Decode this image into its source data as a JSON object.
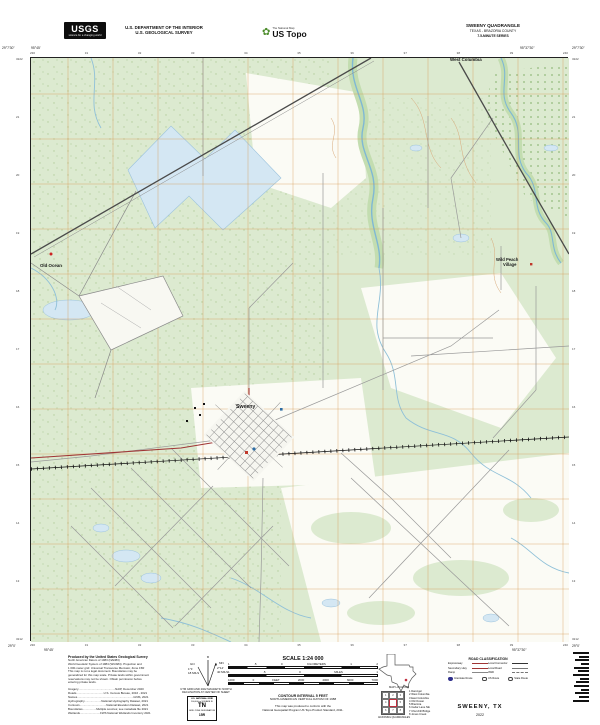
{
  "header": {
    "usgs_logo_text": "USGS",
    "usgs_tagline": "science for a changing world",
    "dept_line1": "U.S. DEPARTMENT OF THE INTERIOR",
    "dept_line2": "U.S. GEOLOGICAL SURVEY",
    "ustopo_small": "The National Map",
    "ustopo_large": "US Topo",
    "quad_line1": "SWEENY QUADRANGLE",
    "quad_line2": "TEXAS - BRAZORIA COUNTY",
    "quad_line3": "7.5-MINUTE SERIES"
  },
  "map": {
    "corner_tl_lat": "29°7'30\"",
    "corner_tl_lon": "95°45'",
    "corner_tr_lat": "29°7'30\"",
    "corner_tr_lon": "95°37'30\"",
    "corner_bl_lat": "29°0'",
    "corner_bl_lon": "95°45'",
    "corner_br_lat": "29°0'",
    "corner_br_lon": "95°37'30\"",
    "top_ticks": [
      "230",
      "31",
      "32",
      "33",
      "34",
      "35",
      "36",
      "37",
      "38",
      "39",
      "240"
    ],
    "bottom_ticks": [
      "230",
      "31",
      "32",
      "33",
      "34",
      "35",
      "36",
      "37",
      "38",
      "39",
      "240"
    ],
    "left_ticks": [
      "3222",
      "21",
      "20",
      "19",
      "18",
      "17",
      "16",
      "15",
      "14",
      "13",
      "3212"
    ],
    "right_ticks": [
      "3222",
      "21",
      "20",
      "19",
      "18",
      "17",
      "16",
      "15",
      "14",
      "13",
      "3212"
    ],
    "labels": {
      "town": "Sweeny",
      "old_ocean": "Old Ocean",
      "west_columbia": "West Columbia",
      "wild_peach_1": "Wild Peach",
      "wild_peach_2": "Village"
    }
  },
  "footer": {
    "credits_title": "Produced by the United States Geological Survey",
    "credits_lines": [
      "North American Datum of 1983 (NAD83)",
      "World Geodetic System of 1984 (WGS84). Projection and",
      "1 000-meter grid: Universal Transverse Mercator, Zone 15R",
      "This map is not a legal document. Boundaries may be",
      "generalized for this map scale. Private lands within government",
      "reservations may not be shown. Obtain permission before",
      "entering private lands."
    ],
    "source_lines": [
      "Imagery..............................................NAIP, December 2020",
      "Roads..................................U.S. Census Bureau, 2016 - 2021",
      "Names......................................................................GNIS, 2021",
      "Hydrography.....................National Hydrography Dataset, 2021",
      "Contours.................................National Elevation Dataset, 2021",
      "Boundaries.................Multiple sources; see metadata file 2021",
      "Wetlands.........................FWS National Wetlands Inventory 2021"
    ],
    "declination": {
      "star": "★",
      "mn_label": "MN",
      "mn_deg": "2°14'",
      "mn_mils": "40 MILS",
      "gn_label": "GN",
      "gn_deg": "1°1'",
      "gn_mils": "18 MILS",
      "caption1": "UTM GRID AND 2022 MAGNETIC NORTH",
      "caption2": "DECLINATION AT CENTER OF SHEET"
    },
    "usng": {
      "title": "U.S. NATIONAL GRID",
      "subtitle": "100,000-m SQUARE ID",
      "square_id": "TN",
      "zone_label": "GRID ZONE DESIGNATION",
      "zone": "15R"
    },
    "scale": {
      "title": "SCALE 1:24 000",
      "km_ticks": [
        "1",
        ".5",
        "0",
        "KILOMETERS",
        "1",
        "2"
      ],
      "mi_ticks": [
        "1",
        ".5",
        "0",
        "MILES",
        "1"
      ],
      "ft_ticks": [
        "1000",
        "0",
        "FEET",
        "2000",
        "4000",
        "6000",
        "7000"
      ]
    },
    "contour_line": "CONTOUR INTERVAL 5 FEET",
    "datum_line": "NORTH AMERICAN VERTICAL DATUM OF 1988",
    "conform_line1": "This map was produced to conform with the",
    "conform_line2": "National Geospatial Program US Topo Product Standard, 2011.",
    "map_location_caption": "MAP LOCATION",
    "adjoining": {
      "caption": "ADJOINING QUADRANGLES",
      "cells": [
        "1",
        "2",
        "3",
        "4",
        "",
        "5",
        "6",
        "7",
        "8"
      ],
      "names": [
        "1 Danciger",
        "2 West Columbia",
        "3 East Columbia",
        "4 Old Ocean",
        "5 Brazoria",
        "6 Cedar Lane NE",
        "7 Churchill Bridge",
        "8 Jones Creek"
      ]
    },
    "road_class": {
      "title": "ROAD CLASSIFICATION",
      "left_rows": [
        {
          "label": "Expressway"
        },
        {
          "label": "Secondary Hwy"
        },
        {
          "label": "Ramp"
        }
      ],
      "right_rows": [
        {
          "label": "Local Connector"
        },
        {
          "label": "Local Road"
        },
        {
          "label": "4WD"
        }
      ],
      "shields": [
        {
          "label": "Interstate Route"
        },
        {
          "label": "US Route"
        },
        {
          "label": "State Route"
        }
      ]
    },
    "sheet_title": "SWEENY, TX",
    "sheet_year": "2022"
  },
  "colors": {
    "map_green": "#dcead0",
    "water_fill": "#d4e7f3",
    "water_line": "#7fb8d4",
    "utm_grid": "#d79950",
    "highway_red": "#a03535"
  }
}
